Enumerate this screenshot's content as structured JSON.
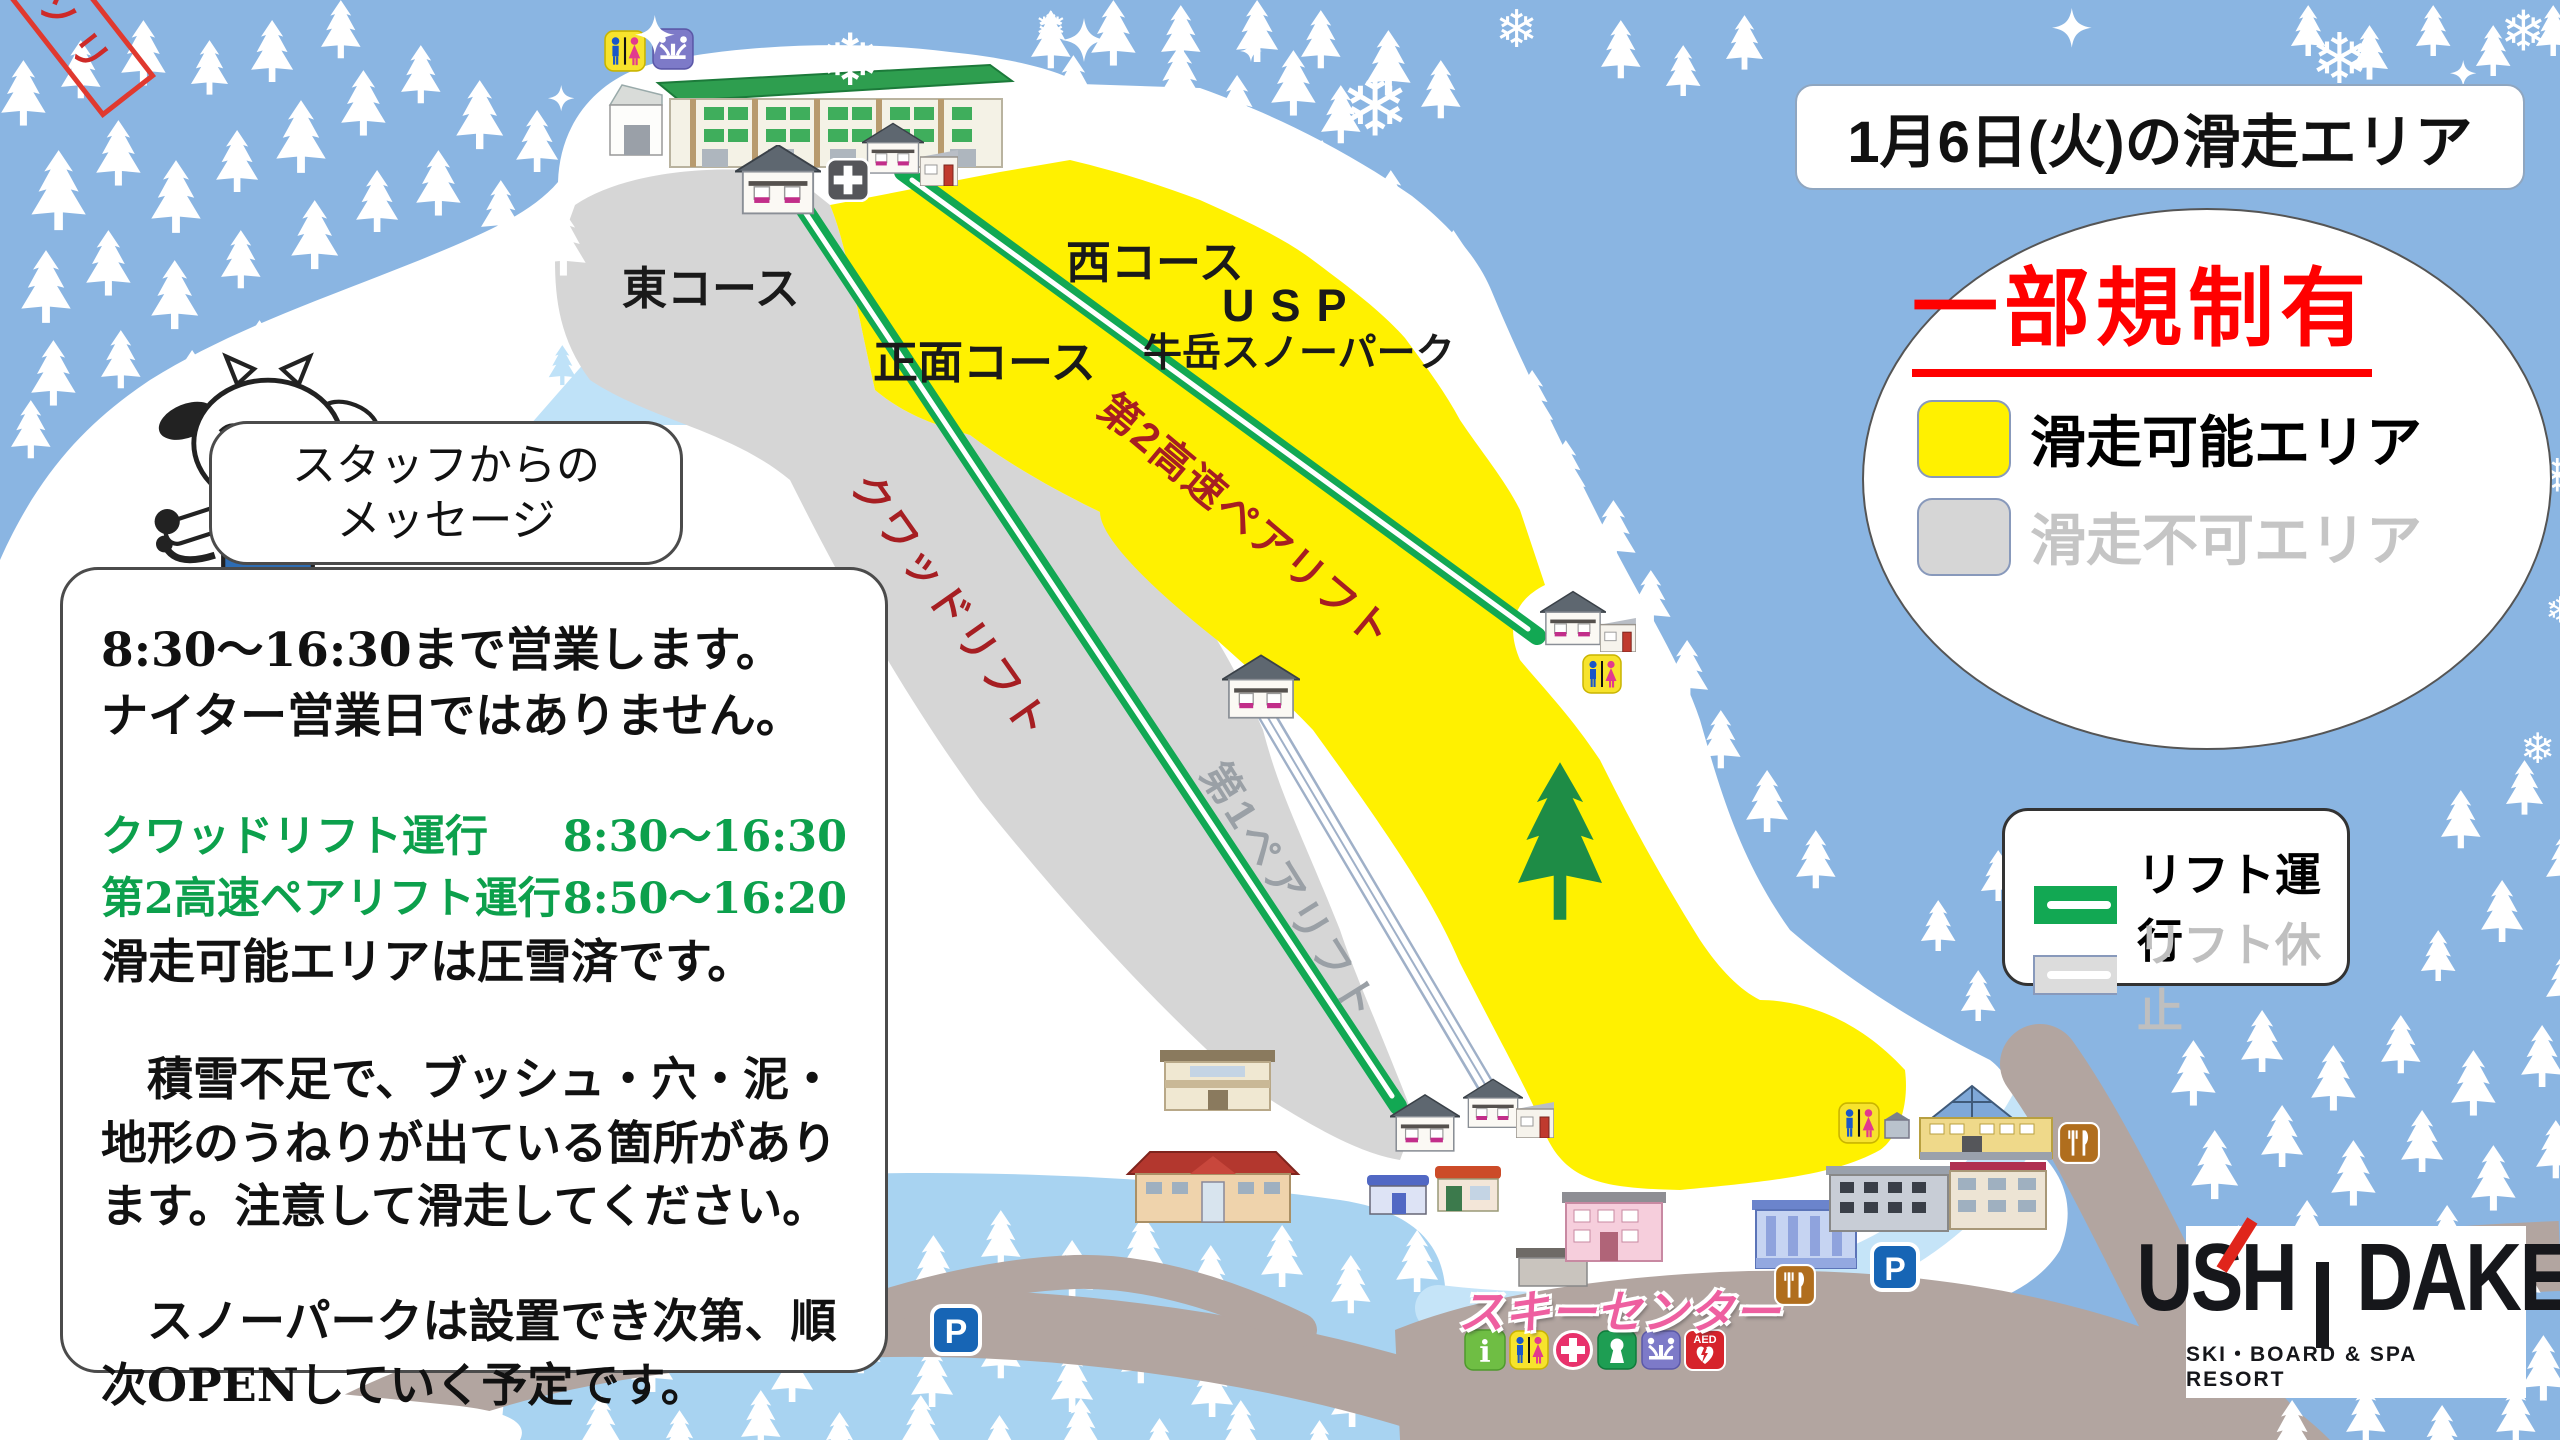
{
  "title_box": {
    "text": "1月6日(火)の滑走エリア"
  },
  "status_circle": {
    "heading": "一部規制有",
    "open_label": "滑走可能エリア",
    "closed_label": "滑走不可エリア"
  },
  "lift_legend": {
    "run_label": "リフト運行",
    "stop_label": "リフト休止"
  },
  "staff_bubble": {
    "line1": "スタッフからの",
    "line2": "メッセージ"
  },
  "message_box": {
    "line1": "8:30〜16:30まで営業します。",
    "line2": "ナイター営業日ではありません。",
    "lift1_name": "クワッドリフト運行",
    "lift1_hours": "8:30〜16:30",
    "lift2_name": "第2高速ペアリフト運行",
    "lift2_hours": "8:50〜16:20",
    "groomed_note": "滑走可能エリアは圧雪済です。",
    "para1": "　積雪不足で、ブッシュ・穴・泥・地形のうねりが出ている箇所があります。注意して滑走してください。",
    "para2": "　スノーパークは設置でき次第、順次OPENしていく予定です。"
  },
  "course_labels": {
    "east": "東コース",
    "front": "正面コース",
    "west": "西コース",
    "usp": "USP",
    "usp_sub": "牛岳スノーパーク"
  },
  "lift_labels": {
    "quad": "クワッドリフト",
    "pair2": "第2高速ペアリフト",
    "pair1": "第1ペアリフト"
  },
  "sled_sign": "ソリ",
  "ski_center": {
    "label": "スキーセンター",
    "info_letter": "i",
    "aed_text": "AED"
  },
  "parking": "P",
  "logo": {
    "left": "USH",
    "right": "DAKE",
    "tagline": "SKI・BOARD & SPA RESORT"
  },
  "colors": {
    "open_area": "#FFF100",
    "closed_area": "#D6D6D6",
    "lift_run": "#12A853",
    "lift_stop": "#DCDCDC",
    "alert_red": "#FF0000"
  }
}
